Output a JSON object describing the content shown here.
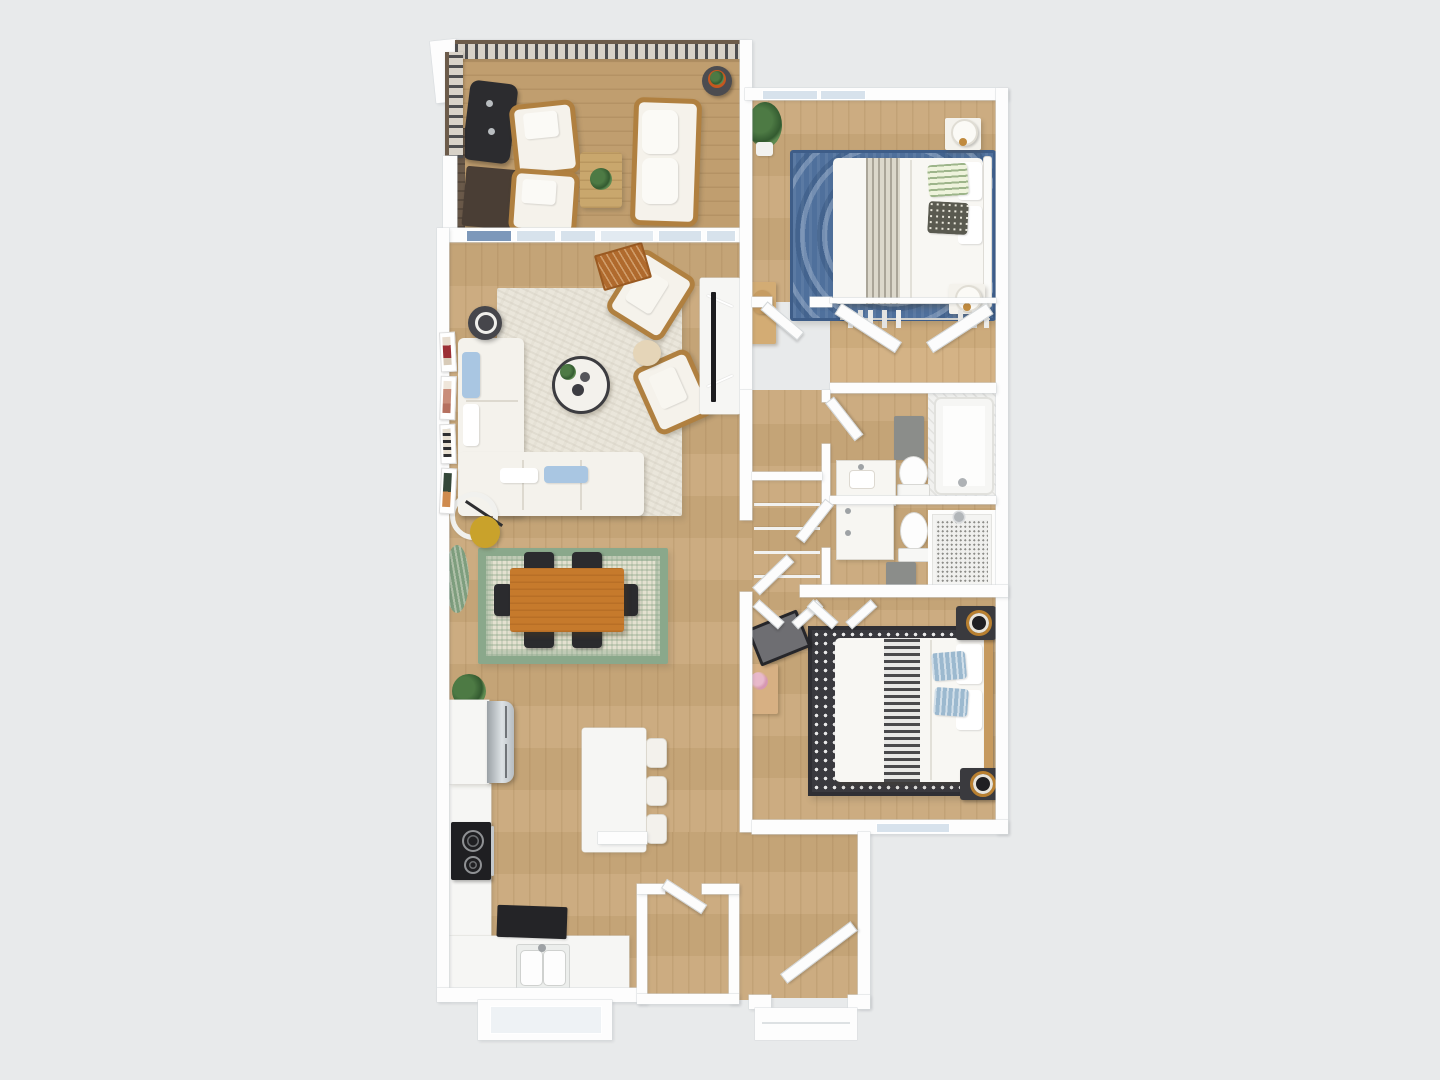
{
  "scene": {
    "type": "3D rendered top-down apartment floor plan",
    "description": "Furnished 2-bedroom, 2-bathroom apartment with balcony, rendered in birds-eye 3D on a plain light gray background",
    "background_color": "#e8eaeb",
    "wall_color": "#fdfdfd",
    "floor_wood_color": "#c9a87a",
    "deck_wood_color": "#c09e6f",
    "counts": {
      "bedrooms": 2,
      "bathrooms": 2,
      "balconies": 1
    }
  },
  "rooms": {
    "balcony": {
      "name": "Balcony",
      "furniture": [
        "metal railing",
        "gas grill",
        "dark wood console",
        "privacy panel",
        "lounge chair (2)",
        "outdoor loveseat",
        "wood coffee table with plant",
        "plant side table"
      ]
    },
    "living_room": {
      "name": "Living Room",
      "furniture": [
        "L-shaped white sectional sofa",
        "light-blue accent pillows",
        "round coffee table",
        "rattan armchair (2)",
        "round pouf",
        "dark round side table",
        "arc floor lamp with gold shade",
        "cream area rug",
        "gallery wall (4 frames)",
        "white TV console",
        "flat-screen TV",
        "script doormat",
        "balcony windows with blinds"
      ]
    },
    "dining_area": {
      "name": "Dining Area",
      "furniture": [
        "rectangular orange-wood dining table",
        "black dining chair (6)",
        "green-and-cream area rug",
        "potted plant",
        "green oval rug"
      ]
    },
    "kitchen": {
      "name": "Kitchen",
      "furniture": [
        "stainless refrigerator",
        "range with black cooktop",
        "L-shaped white counter",
        "double-basin sink",
        "white island",
        "bar stool (3)",
        "black floor mat",
        "window below sink"
      ]
    },
    "entry": {
      "name": "Entry",
      "furniture": [
        "open front door",
        "entry closet with door",
        "exterior stoop"
      ]
    },
    "hallway": {
      "name": "Hallway",
      "furniture": [
        "linen closet with wire shelves",
        "interior doors"
      ]
    },
    "primary_bedroom": {
      "name": "Primary Bedroom",
      "furniture": [
        "bed with white duvet and striped throw",
        "green patterned pillow",
        "dark patterned pillow",
        "white metal headboard",
        "nightstand with drum lamp (2)",
        "blue medallion rug",
        "wood desk with chair",
        "potted plant",
        "walk-in closet with bifold doors and hanging rod",
        "windows"
      ]
    },
    "primary_bathroom": {
      "name": "Primary Bathroom",
      "furniture": [
        "bathtub with tile surround",
        "toilet",
        "marble vanity",
        "gray bath mat"
      ]
    },
    "hall_bathroom": {
      "name": "Hall Bathroom",
      "furniture": [
        "marble vanity",
        "toilet",
        "walk-in shower with mosaic floor",
        "gray bath mat"
      ]
    },
    "second_bedroom": {
      "name": "Second Bedroom",
      "furniture": [
        "bed with white duvet and ticking-stripe runner",
        "blue striped pillows",
        "wood headboard",
        "dark speaker nightstand (2)",
        "black-and-white dotted rug",
        "desk with pink flowers",
        "TV on stand",
        "reach-in closet with bifold doors",
        "window"
      ]
    }
  },
  "palette": {
    "rug_blue": "#4f709c",
    "rug_cream": "#eae6db",
    "rug_green_border": "#8aa88b",
    "rug_bw": "#3a3a3f",
    "dining_table": "#c67a2c",
    "chair_black": "#2b2b2e",
    "rattan": "#b08040",
    "grill": "#2c2c2f",
    "lamp_gold": "#c9a22b",
    "speaker_gold": "#b98030",
    "mat_gray": "#8b8d8a",
    "marble": "#f7f6f2",
    "doormat": "#b06a2d",
    "glass": "#d7e2ec"
  }
}
